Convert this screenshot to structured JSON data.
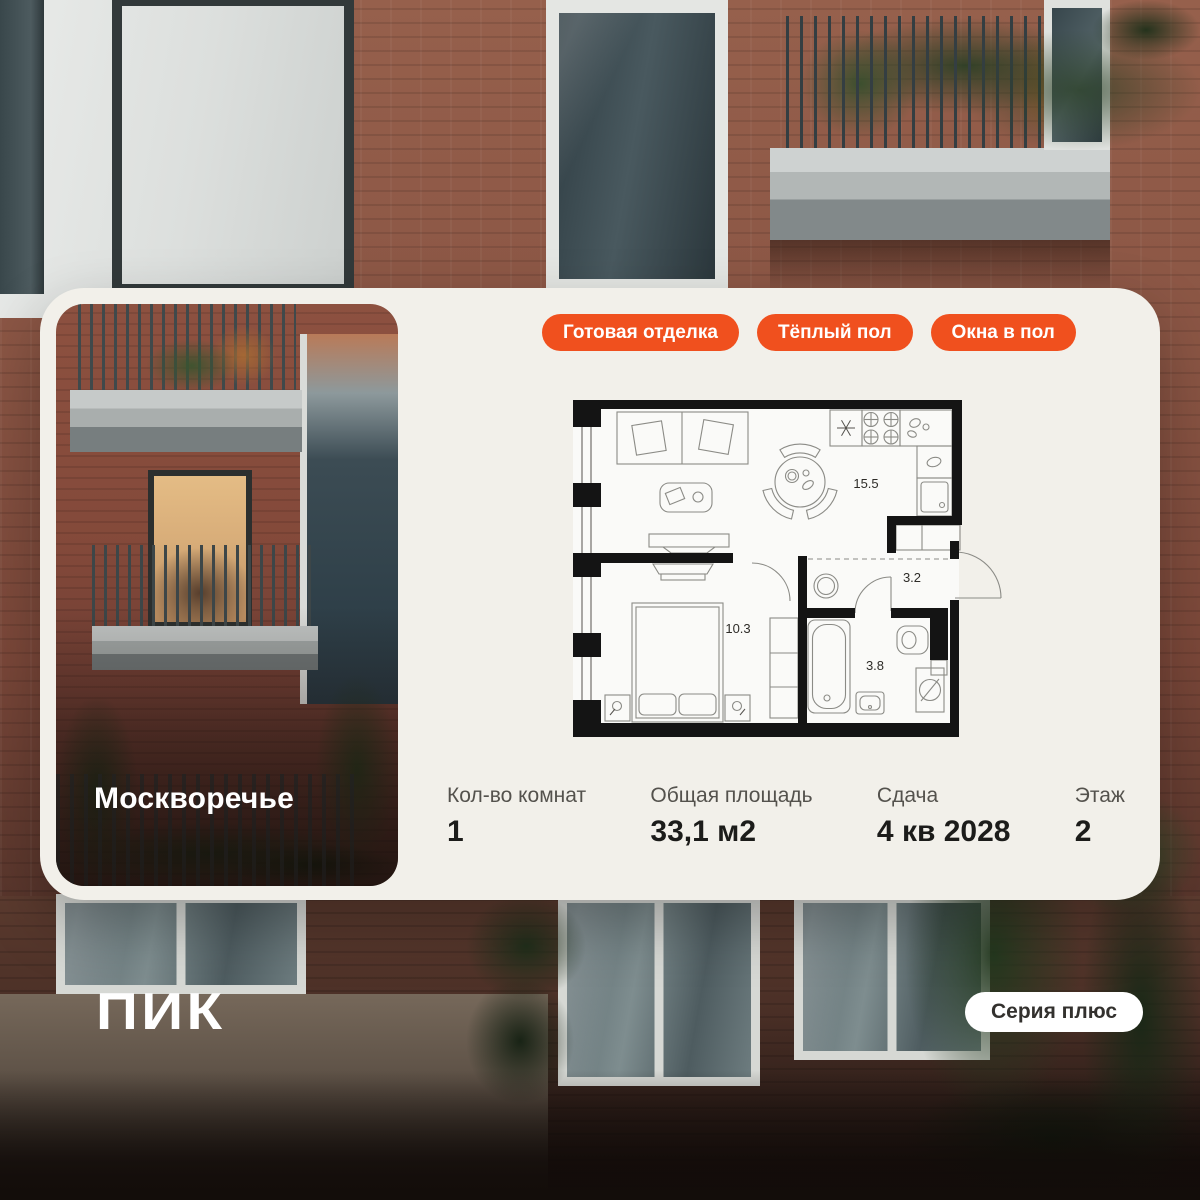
{
  "colors": {
    "accent_orange": "#F0501E",
    "card_background": "#F2F0EA",
    "pill_background": "#FFFFFF",
    "text_dark": "#1C1C1A",
    "label_gray": "#54524D"
  },
  "card": {
    "project_name": "Москворечье",
    "badges": [
      {
        "label": "Готовая отделка"
      },
      {
        "label": "Тёплый пол"
      },
      {
        "label": "Окна в пол"
      }
    ],
    "floor_plan": {
      "rooms": [
        {
          "name": "kitchen-living-room",
          "area": "15.5"
        },
        {
          "name": "hallway",
          "area": "3.2"
        },
        {
          "name": "bedroom",
          "area": "10.3"
        },
        {
          "name": "bathroom",
          "area": "3.8"
        }
      ]
    },
    "stats": [
      {
        "label": "Кол-во комнат",
        "value": "1"
      },
      {
        "label": "Общая площадь",
        "value": "33,1 м2"
      },
      {
        "label": "Сдача",
        "value": "4 кв 2028"
      },
      {
        "label": "Этаж",
        "value": "2"
      }
    ]
  },
  "footer": {
    "logo_text": "ПИК",
    "series_label": "Серия плюс"
  }
}
